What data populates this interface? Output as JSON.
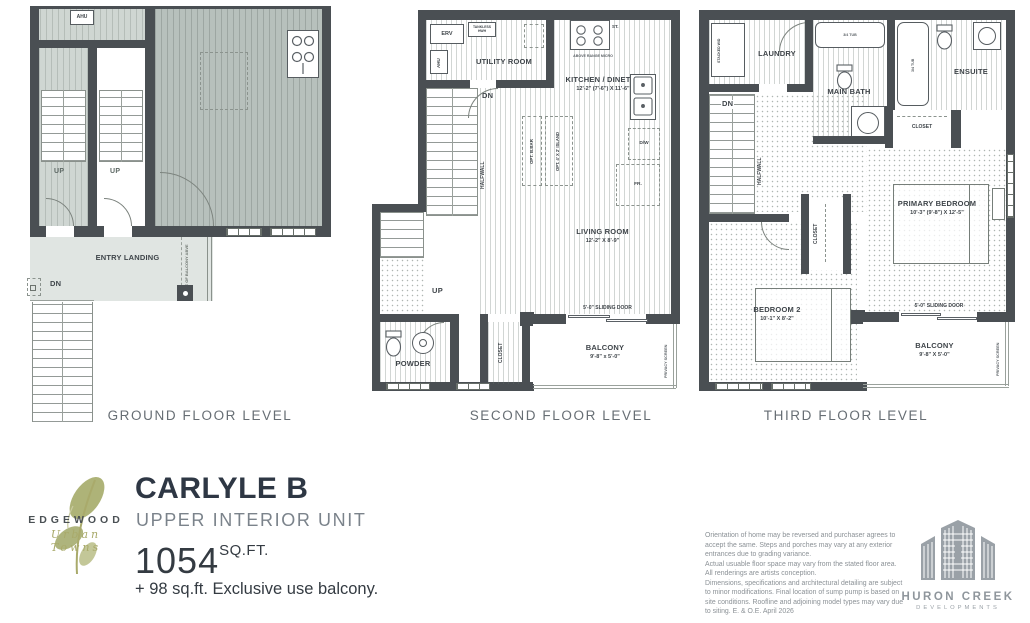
{
  "plans": {
    "ground": {
      "label": "GROUND FLOOR LEVEL",
      "ahu": "AHU",
      "up_left": "UP",
      "up_right": "UP",
      "dn": "DN",
      "entry_landing": "ENTRY LANDING",
      "line_of_balcony": "LINE OF BALCONY ABVE"
    },
    "second": {
      "label": "SECOND FLOOR LEVEL",
      "erv": "ERV",
      "tankless": "TANKLESS HWH",
      "ahu": "AHU",
      "utility": "UTILITY ROOM",
      "stove": "ST.",
      "micro": "ABOVE RANGE MICRO",
      "kitchen": "KITCHEN / DINETTE",
      "kitchen_dim": "12'-2\" (7'-6\") X 11'-6\"",
      "dn": "DN",
      "up": "UP",
      "halfwall": "HALFWALL",
      "opt_bar": "OPT. B.BAR",
      "opt_island": "OPT. 4' X 2' ISLAND",
      "dw": "D/W",
      "fridge": "FR.",
      "living": "LIVING ROOM",
      "living_dim": "12'-2\" X 8'-9\"",
      "sliding_door": "5'-0\" SLIDING DOOR",
      "closet": "CLOSET",
      "powder": "POWDER",
      "balcony": "BALCONY",
      "balcony_dim": "9'-8\" x 5'-0\"",
      "privacy": "PRIVACY SCREEN"
    },
    "third": {
      "label": "THIRD FLOOR LEVEL",
      "laundry": "LAUNDRY",
      "stacked_wd": "STACKED W/D",
      "main_bath": "MAIN BATH",
      "tub_main": "3/4 TUB",
      "tub_ensuite": "3/4 TUB",
      "ensuite": "ENSUITE",
      "closet_bath": "CLOSET",
      "dn": "DN",
      "halfwall": "HALFWALL",
      "closet_bed": "CLOSET",
      "primary": "PRIMARY BEDROOM",
      "primary_dim": "10'-3\" (9'-8\") X 12'-5\"",
      "bedroom2": "BEDROOM 2",
      "bedroom2_dim": "10'-1\" X 8'-2\"",
      "sliding_door": "5'-0\" SLIDING DOOR",
      "balcony": "BALCONY",
      "balcony_dim": "9'-8\" X 5'-0\"",
      "privacy": "PRIVACY SCREEN"
    }
  },
  "title_block": {
    "brand": "EDGEWOOD",
    "brand_script": "Urban Towns",
    "model": "CARLYLE B",
    "unit_type": "UPPER INTERIOR UNIT",
    "area": "1054",
    "area_unit": "SQ.FT.",
    "balcony_note": "+ 98 sq.ft. Exclusive use balcony."
  },
  "disclaimer": {
    "paragraphs": [
      "Orientation of home may be reversed and purchaser agrees to accept the same. Steps and porches may vary at any exterior entrances due to grading variance.",
      "Actual usuable floor space may vary from the stated floor area. All renderings are artists conception.",
      "Dimensions, specifications and architectural detailing are subject to minor modifications. Final location of sump pump is based on site conditions. Roofline and adjoining model types may vary due to siting. E. & O.E. April 2026"
    ]
  },
  "developer": {
    "name": "HURON CREEK",
    "subtitle": "DEVELOPMENTS"
  },
  "colors": {
    "wall": "#4a4f53",
    "neighbor_fill": "#b7c0bc",
    "landing_fill": "#e0e5e2",
    "title_dark": "#2e3744",
    "logo_olive": "#a9aa6b",
    "developer_gray": "#9aa1a7"
  }
}
